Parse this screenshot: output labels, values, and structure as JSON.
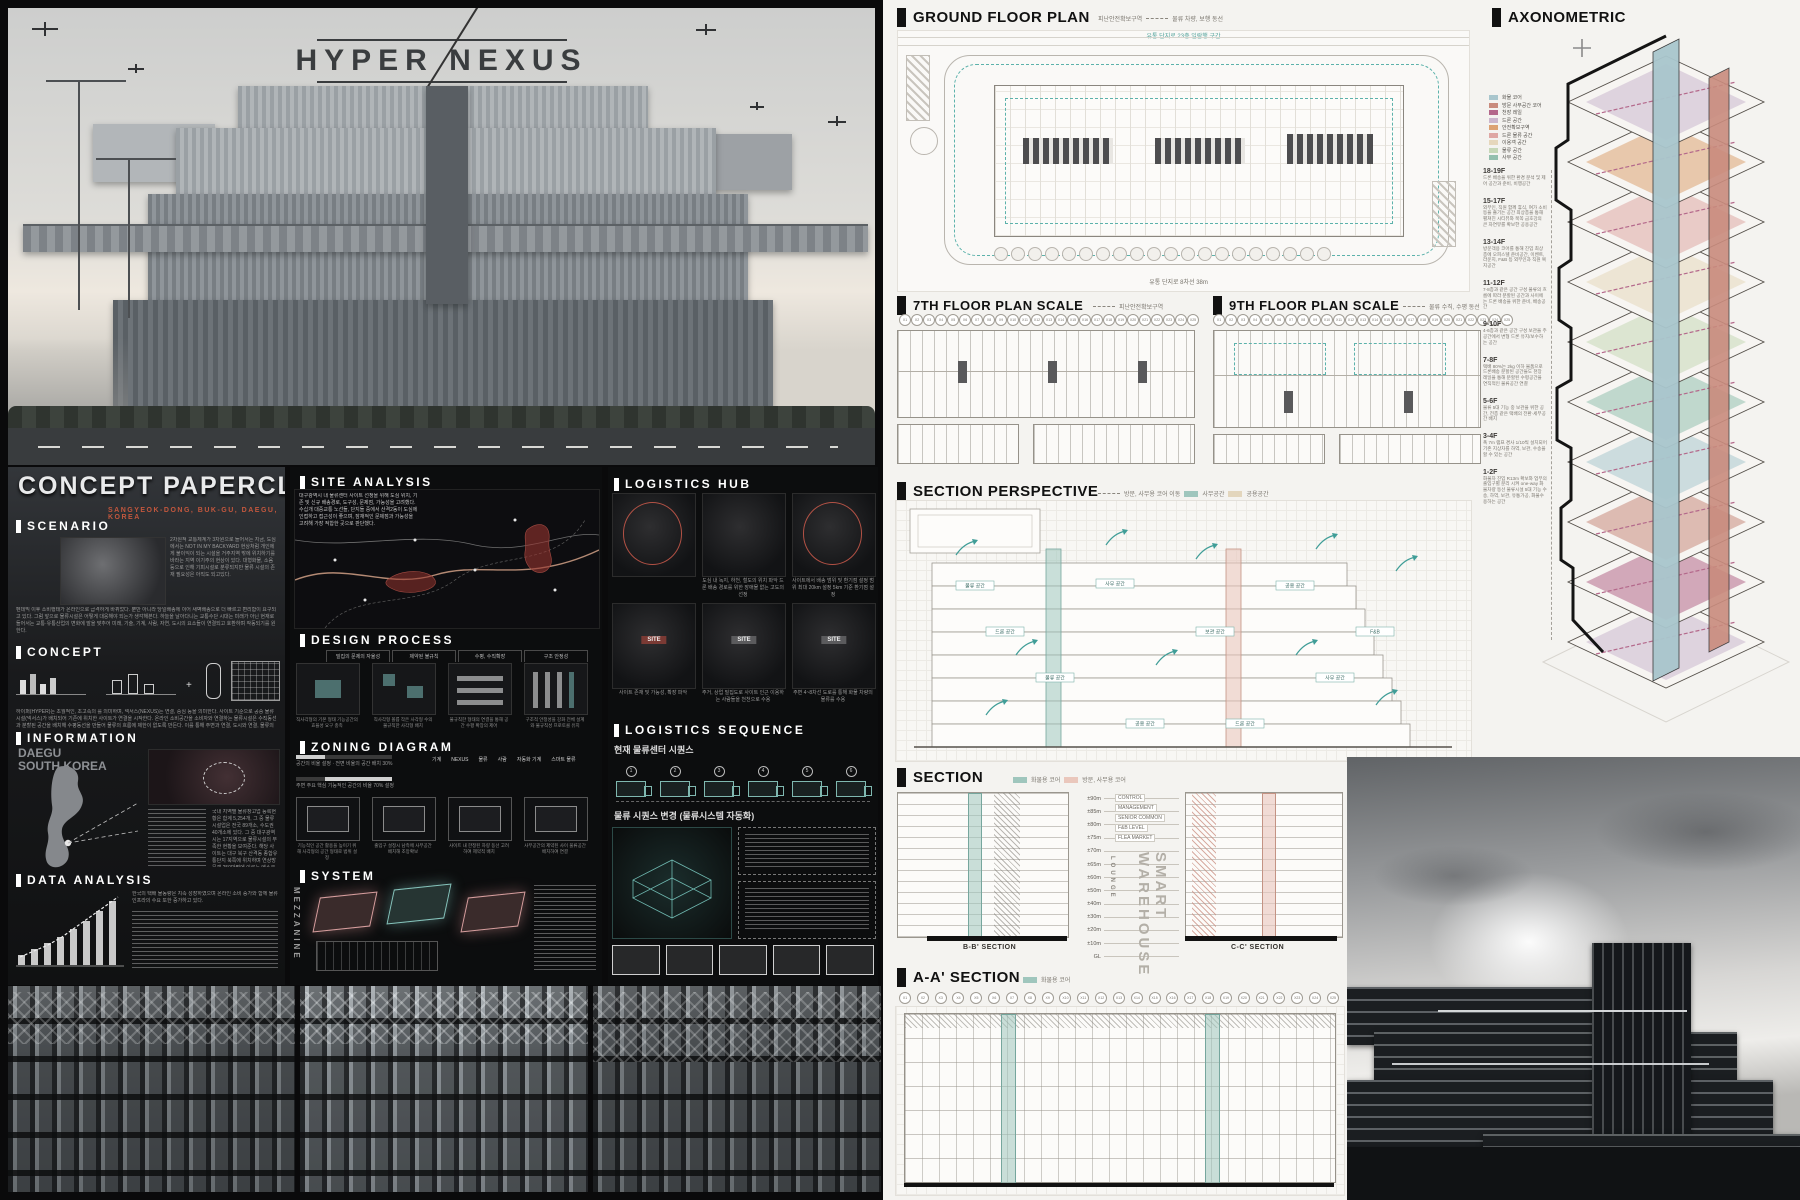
{
  "hero": {
    "title": "HYPER NEXUS",
    "subtitle": "물류의 혁신 - 근미래 드론을 활용한 물류시설의 프로토타입"
  },
  "concept": {
    "title": "CONCEPT PAPERCLIP",
    "location": "SANGYEOK-DONG, BUK-GU, DAEGU, KOREA",
    "scenario": {
      "label": "SCENARIO",
      "side": "2차원적 교통체계가 3차원으로 들어서는 지금, 도심에서는 NOT IN MY BACKYARD 현상처럼 개인에게 불이익이 되는 시설을 거주지역 밖에 위치하기를 바라는 지역 이기주의 현상이 있다. 대형화물, 소음 등으로 인해 기피시설로 분류되지만 물류 시설의 존재 필요성은 아직도 되고있다.",
      "body": "펜데믹 이후 소비행태가 온라인으로 급격하게 바뀌었다. 뿐만 아니라 당일배송에 이어 새벽배송으로 더 빠르고 편리함이 요구되고 있다. 그럼 앞으로 물류시설은 어떻게 대응해야 되는가 생각해본다. 하늘을 날아다니는 교통수단 시대는 미래가 아닌 현재로 들어서는 교통·유통산업의 변화에 발을 맞추어 미래, 기술, 기계, 사람, 자연, 도시의 요소들이 연결되고 호환하며 작동되기를 원한다."
    },
    "concept_sec": {
      "label": "CONCEPT",
      "body": "하이퍼(HYPER)는 초월적인, 초고속의 를 의미하며, 넥서스(NEXUS)는 연결, 중심 등을 의미한다. 사이트 기준으로 공중 물류시설(넥서스)가 배치되어 기존에 위치한 사이트가 연결을 시작한다. 온라인 소비공간을 소비자와 연결하는 물류시설은 수직동선과 분할된 공간을 배치해 수평동선을 만들어 물류의 흐름에 제한이 없도록 만든다. 이를 통해 주변과 연결, 도시와 연결, 물류의 동선, 공간을 연결한다."
    },
    "information": {
      "label": "INFORMATION",
      "place": "DAEGU",
      "country": "SOUTH KOREA",
      "body": "국내 지역별 물류창고업 등록현황은 합계 5,254개, 그 중 물류시설업은 전국 89개소, 수도권 40개소에 있다. 그 중 대구광역시는 17지역으로 물류시설의 부족한 현황을 보여준다. 해당 사이트는 대구 북구 산격동 종합유통단지 북쪽에 위치하며 연상방문객 250만명에 이르는 엑스코와 공업지역, 주거지역이 인접해 있다. 현재는 점포 수가 줄어드는 등 쇠퇴해 가고 있다."
    },
    "data_analysis": {
      "label": "DATA ANALYSIS",
      "body": "한국의 택배 물동량은 지속 성장하였으며 온라인 소비 증가와 함께 물류 인프라의 수요 또한 증가하고 있다."
    }
  },
  "middle": {
    "site_analysis": {
      "label": "SITE ANALYSIS",
      "body": "대구광역시 내 물류센터 사이트 선정을 위해 도심 위치, 기존 및 신규 배송경로, 도구성, 문제점, 가능성을 고려했다. 수십개 대중교통 노선들, 단지들 중에서 산격2동이 도심에 인접하고 접근성이 좋으며, 잠재적인 문제점과 가능성을 고려해 가장 적합한 곳으로 판단했다."
    },
    "design_process": {
      "label": "DESIGN PROCESS",
      "tabs": [
        "밀집의 문제의 자율성",
        "제약된 불규칙",
        "수평, 수직확장",
        "구조 안정성"
      ],
      "captions": [
        "직사각형의 기본 형태 기능공간의 효율성 요구 충족",
        "직사각형 볼륨 작은 사각형 수의 불규칙한 사각형 배치",
        "불규칙한 형태의 연결을 통해 공간 수평 확장의 제어",
        "구조적 안정성을 강화 전체 설계와 불규칙성 프로토콜 유지"
      ]
    },
    "zoning": {
      "label": "ZONING DIAGRAM",
      "note1": "공간의 비율 설정 · 전면 비율의 공간 배치 30%",
      "note2": "주변 주요 핵심 기능적인 공간의 비율 70% 설정",
      "icons": [
        "기계",
        "NEXUS",
        "물류",
        "사람",
        "자동화 기계",
        "스마트 물류"
      ],
      "captions": [
        "기능적인 공간 활용을 높이기 위해 사각형의 공간 형태로 범위 설정",
        "출입구 설정시 남측에 사무공간 배치해 조망확보",
        "사이트 내 한정된 차량 동선 고려하여 제약적 배치",
        "사무공간의 제약된 사이 물류공간 배치하여 연결"
      ]
    },
    "system": {
      "label": "SYSTEM",
      "mezzanine": "MEZZANINE"
    }
  },
  "hub": {
    "label": "LOGISTICS HUB",
    "row1_captions": [
      "도심 내 녹지, 하천, 철도의 위치 파악 드론 배송 경로를 위한 장애물 없는 고도의 선정",
      "사이트에서 배송 범위 및 환기점 설정 범위 최대 20km 설정 5km 기준 환기점 설정"
    ],
    "row2_captions": [
      "사이트 존재 및 가능성, 확장 파악",
      "주거, 상업 밀집도로 사이트 인근 이용하는 사람들을 천천으로 수용",
      "주변 4~8차선 도로를 통해 화물 차량의 물류를 수용"
    ],
    "site_chip": "SITE",
    "sequence": {
      "label": "LOGISTICS SEQUENCE",
      "subtitle": "현재 물류센터 시퀀스",
      "subtitle2": "물류 시퀀스 변경 (물류시스템 자동화)",
      "steps": [
        "1",
        "2",
        "3",
        "4",
        "5",
        "6"
      ]
    }
  },
  "rb": {
    "ground": {
      "title": "GROUND FLOOR PLAN",
      "legend1": "피난안전확보구역",
      "legend2": "물류 차량, 보행 동선",
      "top_note": "유통 단지로 23층 일람행 구간",
      "bottom_note": "유통 단지로 8차선 38m"
    },
    "plan7": {
      "title": "7TH FLOOR PLAN SCALE",
      "legend": "피난안전확보구역"
    },
    "plan9": {
      "title": "9TH FLOOR PLAN SCALE",
      "legend": "물류 수직, 수평 동선"
    },
    "grid_labels": [
      "X1",
      "X2",
      "X3",
      "X4",
      "X5",
      "X6",
      "X7",
      "X8",
      "X9",
      "X10",
      "X11",
      "X12",
      "X13",
      "X14",
      "X15",
      "X16",
      "X17",
      "X18",
      "X19",
      "X20",
      "X21",
      "X22",
      "X23",
      "X24",
      "X25"
    ],
    "sp": {
      "title": "SECTION PERSPECTIVE",
      "legend_dash": "방문, 사무용 코어 이동",
      "legend_sw": [
        {
          "label": "사무공간",
          "color": "#9fc6bd"
        },
        {
          "label": "공용공간",
          "color": "#e3d6bd"
        }
      ],
      "chips": [
        "물류 공간",
        "사무 공간",
        "공용 공간",
        "드론 공간",
        "보관 공간",
        "F&B"
      ]
    },
    "section": {
      "title": "SECTION",
      "legend": [
        {
          "label": "화물용 코어",
          "color": "#9fc6bd"
        },
        {
          "label": "방문, 사무용 코어",
          "color": "#eac7bc"
        }
      ],
      "b_label": "B-B' SECTION",
      "c_label": "C-C' SECTION",
      "vertical": "SMART WAREHOUSE",
      "vertical2": "LOUNGE",
      "levels": [
        "±90m",
        "±85m",
        "±80m",
        "±75m",
        "±70m",
        "±65m",
        "±60m",
        "±50m",
        "±40m",
        "±30m",
        "±20m",
        "±10m",
        "GL"
      ],
      "annotations": [
        "CONTROL",
        "MANAGEMENT",
        "SENIOR COMMON",
        "F&B LEVEL",
        "FLEA MARKET"
      ]
    },
    "aa": {
      "title": "A-A' SECTION",
      "legend": "화물용 코어"
    },
    "axon": {
      "title": "AXONOMETRIC",
      "legend": [
        {
          "label": "화물 코어",
          "color": "#a9c6cd"
        },
        {
          "label": "방문 사무공간 코어",
          "color": "#c98b7d"
        },
        {
          "label": "천장 레일",
          "color": "#b4688b"
        },
        {
          "label": "드론 공간",
          "color": "#cbb6cd"
        },
        {
          "label": "안전확보구역",
          "color": "#dca273"
        },
        {
          "label": "드론 물류 공간",
          "color": "#dfa7a4"
        },
        {
          "label": "이용객 공간",
          "color": "#e6d7bc"
        },
        {
          "label": "물류 공간",
          "color": "#c6d7b7"
        },
        {
          "label": "사무 공간",
          "color": "#93bfae"
        }
      ],
      "floors": [
        {
          "range": "18-19F",
          "desc": "드론 배송을 위한 환경 분석 및 제어 공간과 준비, 비행공간"
        },
        {
          "range": "15-17F",
          "desc": "외부인, 직원 함께 휴식, 여가 소비 등을 즐기는 공간 최상층을 통해 펼쳐진 시티뷰와 북쪽 금호강의 큰 자연뷰를 확보한 공용공간"
        },
        {
          "range": "13-14F",
          "desc": "방문객용 코어를 통해 진입 최상층에 오피스텔 준비공간, 이벤트, 라운지, F&B 등 외부인과 직원 복지공간"
        },
        {
          "range": "11-12F",
          "desc": "7-8층과 같은 공간 구성 물류의 흐름에 따라 분할된 공간과 사이에는 드론 배송을 위한 준비, 배송공간"
        },
        {
          "range": "9-10F",
          "desc": "4-6층과 같은 공간 구성 보관을 주공간에서 변형 드론 유지/보수하는 공간"
        },
        {
          "range": "7-8F",
          "desc": "택배 80%는 2kg 이하 물품으로 드론배송 분할된 공간들도 천장 레일을 통해 분할된 수평공간을 연직적인 물류공간 연결"
        },
        {
          "range": "5-6F",
          "desc": "물류 5대 기능 중 보관을 위한 공간, 전층 같은 택배의 전환·세부공간 배치"
        },
        {
          "range": "3-4F",
          "desc": "폭 7m 램프 경사 1/10씩 설치되어 기존 지상차를 하역, 보관, 수송을 할 수 있는 공간"
        },
        {
          "range": "1-2F",
          "desc": "화물차 진입 R13m 확보와 업무의 출입구별 분리 시켜 one-way 화물차량 동선 물류시설 5대 기능 수송, 하역, 보관, 유통가공, 화물수용하는 공간"
        }
      ]
    }
  },
  "colors": {
    "teal": "#4aa49e",
    "teal_light": "#9fc6bd",
    "pink": "#eac7bc",
    "red": "#c2573d",
    "paper": "#f4f3f0"
  }
}
